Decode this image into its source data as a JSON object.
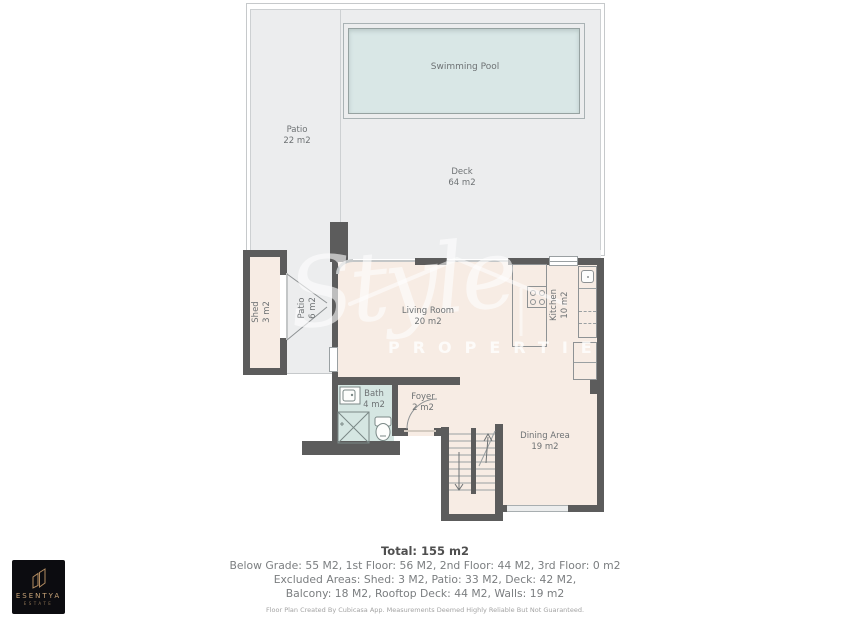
{
  "outdoor": {
    "pool": {
      "label": "Swimming Pool"
    },
    "patio_main": {
      "label": "Patio",
      "area": "22 m2"
    },
    "deck": {
      "label": "Deck",
      "area": "64 m2"
    },
    "patio_small": {
      "label": "Patio",
      "area": "6 m2"
    },
    "shed": {
      "label": "Shed",
      "area": "3 m2"
    }
  },
  "rooms": {
    "living": {
      "label": "Living Room",
      "area": "20 m2"
    },
    "kitchen": {
      "label": "Kitchen",
      "area": "10 m2"
    },
    "bath": {
      "label": "Bath",
      "area": "4 m2"
    },
    "foyer": {
      "label": "Foyer",
      "area": "2 m2"
    },
    "dining": {
      "label": "Dining Area",
      "area": "19 m2"
    }
  },
  "watermark": {
    "script": "Style",
    "caption": "PROPERTIES"
  },
  "summary": {
    "total": "Total: 155 m2",
    "floors": "Below Grade: 55 M2, 1st Floor: 56 M2, 2nd Floor: 44 M2, 3rd Floor: 0 m2",
    "excluded_1": "Excluded Areas: Shed: 3 M2, Patio: 33 M2, Deck: 42 M2,",
    "excluded_2": "Balcony: 18 M2, Rooftop Deck: 44 M2, Walls: 19 m2",
    "disclaimer": "Floor Plan Created By Cubicasa App. Measurements Deemed Highly Reliable But Not Guaranteed."
  },
  "logo": {
    "name": "ESENTYA",
    "tagline": "ESTATE"
  },
  "colors": {
    "wall": "#5c5c5c",
    "interior": "#f7ece4",
    "bath": "#d5e6e2",
    "pool": "#d9e7e6",
    "ground": "#ecedee",
    "logo_accent": "#c8a478"
  }
}
